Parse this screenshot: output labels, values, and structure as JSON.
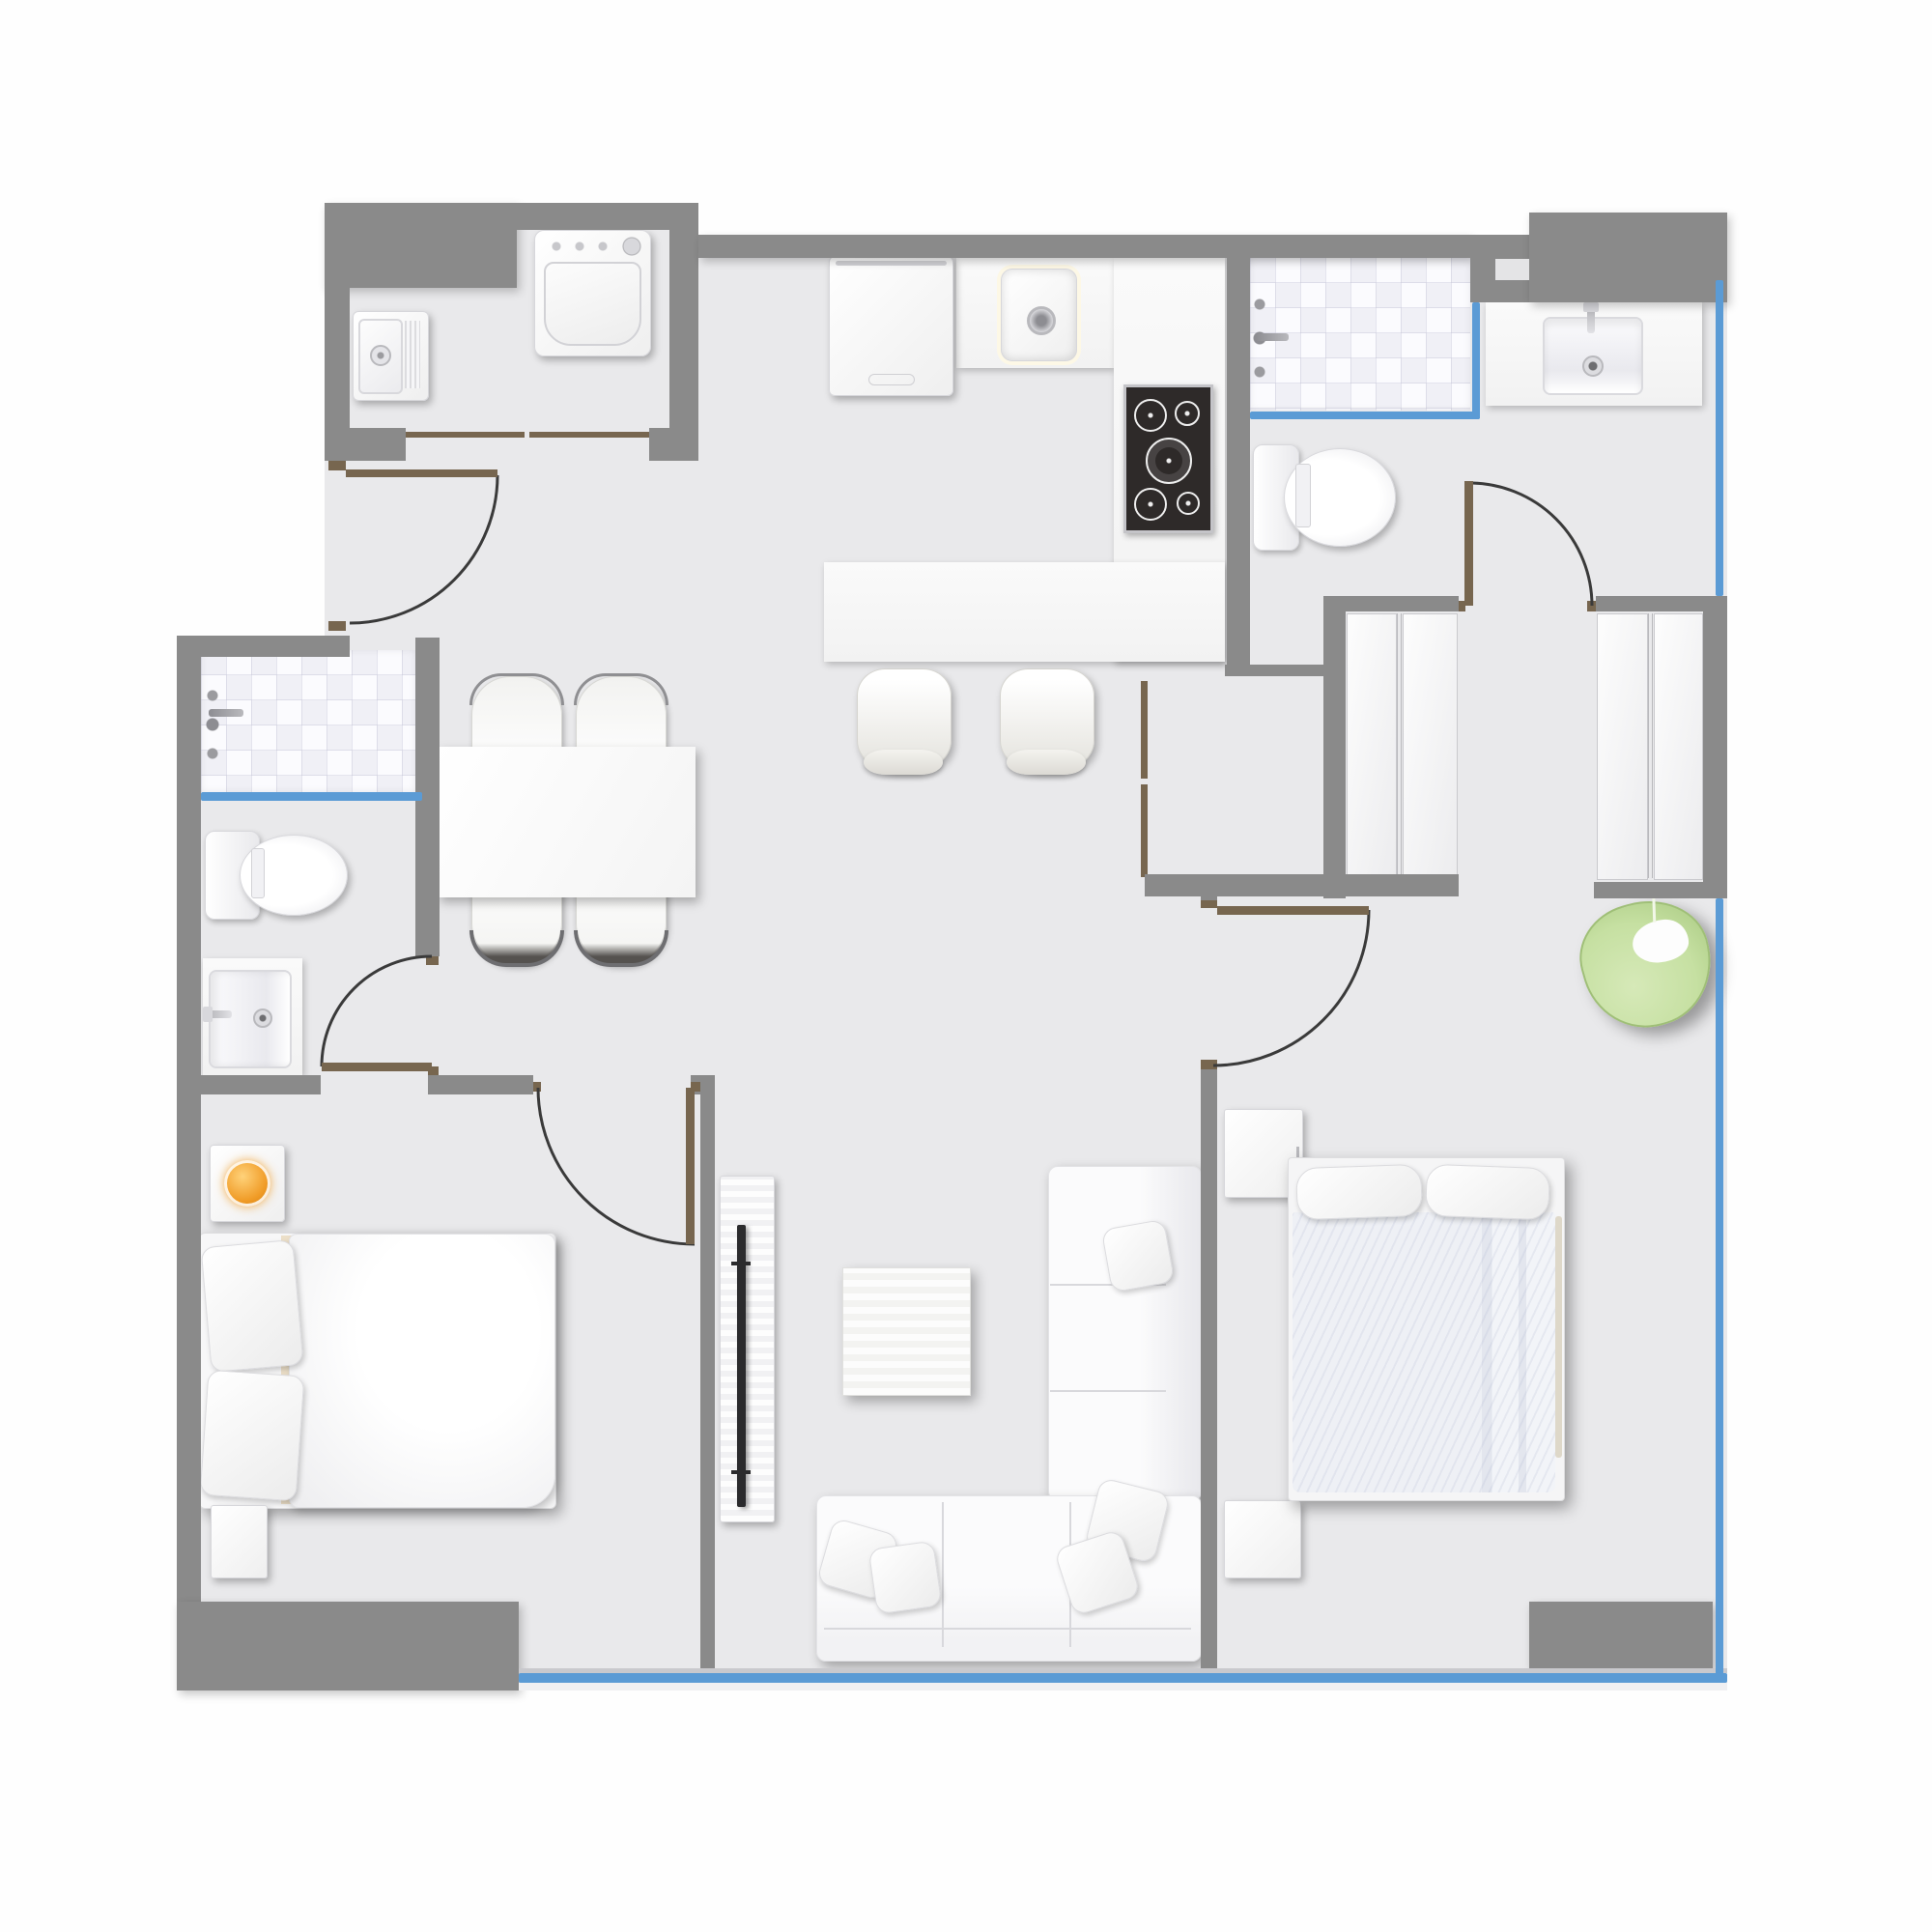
{
  "title": "Two-bedroom apartment floor plan (top view)",
  "colors": {
    "outside": "#fefefe",
    "floor": "#e9e9eb",
    "wall": "#8a8a8a",
    "door": "#77664f",
    "arc": "#3a3a3a",
    "glass": "#5b9bd5",
    "counter": "#f6f6f6",
    "cooktop": "#2e2a29",
    "lamp": "#f09b26",
    "beanbag": "#c6e0a2"
  },
  "rooms": [
    {
      "id": "laundry",
      "name": "Laundry room",
      "furniture": [
        {
          "id": "washer",
          "name": "Washing machine"
        },
        {
          "id": "utility-sink",
          "name": "Utility sink"
        }
      ]
    },
    {
      "id": "kitchen",
      "name": "Kitchen",
      "furniture": [
        {
          "id": "refrigerator",
          "name": "Refrigerator"
        },
        {
          "id": "kitchen-sink",
          "name": "Kitchen sink"
        },
        {
          "id": "cooktop",
          "name": "Cooktop with five burners"
        },
        {
          "id": "kitchen-counter",
          "name": "Kitchen counter"
        },
        {
          "id": "kitchen-island",
          "name": "Kitchen island / breakfast bar"
        },
        {
          "id": "bar-stool-1",
          "name": "Bar stool"
        },
        {
          "id": "bar-stool-2",
          "name": "Bar stool"
        }
      ]
    },
    {
      "id": "dining",
      "name": "Dining area",
      "furniture": [
        {
          "id": "dining-table",
          "name": "Dining table"
        },
        {
          "id": "dining-chair-1",
          "name": "Dining chair"
        },
        {
          "id": "dining-chair-2",
          "name": "Dining chair"
        },
        {
          "id": "dining-chair-3",
          "name": "Dining chair"
        },
        {
          "id": "dining-chair-4",
          "name": "Dining chair"
        }
      ]
    },
    {
      "id": "bathroom-main",
      "name": "Main bathroom (top right)",
      "furniture": [
        {
          "id": "shower-main",
          "name": "Tiled shower with glass screen"
        },
        {
          "id": "toilet-main",
          "name": "Toilet"
        },
        {
          "id": "vanity-main",
          "name": "Vanity sink"
        }
      ]
    },
    {
      "id": "closet-hall",
      "name": "Closet hallway",
      "furniture": [
        {
          "id": "closet-left",
          "name": "Double-door closet"
        },
        {
          "id": "closet-right",
          "name": "Double-door closet"
        },
        {
          "id": "storage-closet",
          "name": "Storage closet with double doors"
        }
      ]
    },
    {
      "id": "bathroom-second",
      "name": "Second bathroom (left)",
      "furniture": [
        {
          "id": "shower-second",
          "name": "Tiled shower with glass screen"
        },
        {
          "id": "toilet-second",
          "name": "Toilet"
        },
        {
          "id": "vanity-second",
          "name": "Vanity sink"
        }
      ]
    },
    {
      "id": "bedroom-left",
      "name": "Left bedroom",
      "furniture": [
        {
          "id": "bed-left",
          "name": "Double bed with pillows"
        },
        {
          "id": "nightstand-left-1",
          "name": "Nightstand with lamp"
        },
        {
          "id": "nightstand-left-2",
          "name": "Nightstand"
        },
        {
          "id": "lamp-left",
          "name": "Orange table lamp"
        }
      ]
    },
    {
      "id": "living",
      "name": "Living room",
      "furniture": [
        {
          "id": "tv-stand",
          "name": "TV console"
        },
        {
          "id": "tv",
          "name": "Flat-screen TV"
        },
        {
          "id": "coffee-table",
          "name": "Coffee table"
        },
        {
          "id": "sofa",
          "name": "L-shaped sectional sofa with cushions"
        }
      ]
    },
    {
      "id": "bedroom-right",
      "name": "Right bedroom",
      "furniture": [
        {
          "id": "bed-right",
          "name": "Double bed with blanket"
        },
        {
          "id": "nightstand-right-1",
          "name": "Nightstand"
        },
        {
          "id": "nightstand-right-2",
          "name": "Nightstand"
        },
        {
          "id": "bean-bag",
          "name": "Green bean-bag chair"
        }
      ]
    }
  ],
  "doors": [
    {
      "id": "entry-door",
      "name": "Entry door (left wall)"
    },
    {
      "id": "laundry-opening",
      "name": "Wide cased opening to laundry"
    },
    {
      "id": "bathroom-second-door",
      "name": "Second bathroom door"
    },
    {
      "id": "bedroom-left-door",
      "name": "Left bedroom door"
    },
    {
      "id": "bedroom-right-door",
      "name": "Right bedroom door"
    },
    {
      "id": "closet-hall-door",
      "name": "Closet hallway door"
    }
  ],
  "windows": [
    {
      "id": "window-right-upper",
      "name": "Window, right wall upper"
    },
    {
      "id": "window-right-lower",
      "name": "Window, right wall lower"
    },
    {
      "id": "window-bottom",
      "name": "Window band, bottom wall"
    }
  ]
}
